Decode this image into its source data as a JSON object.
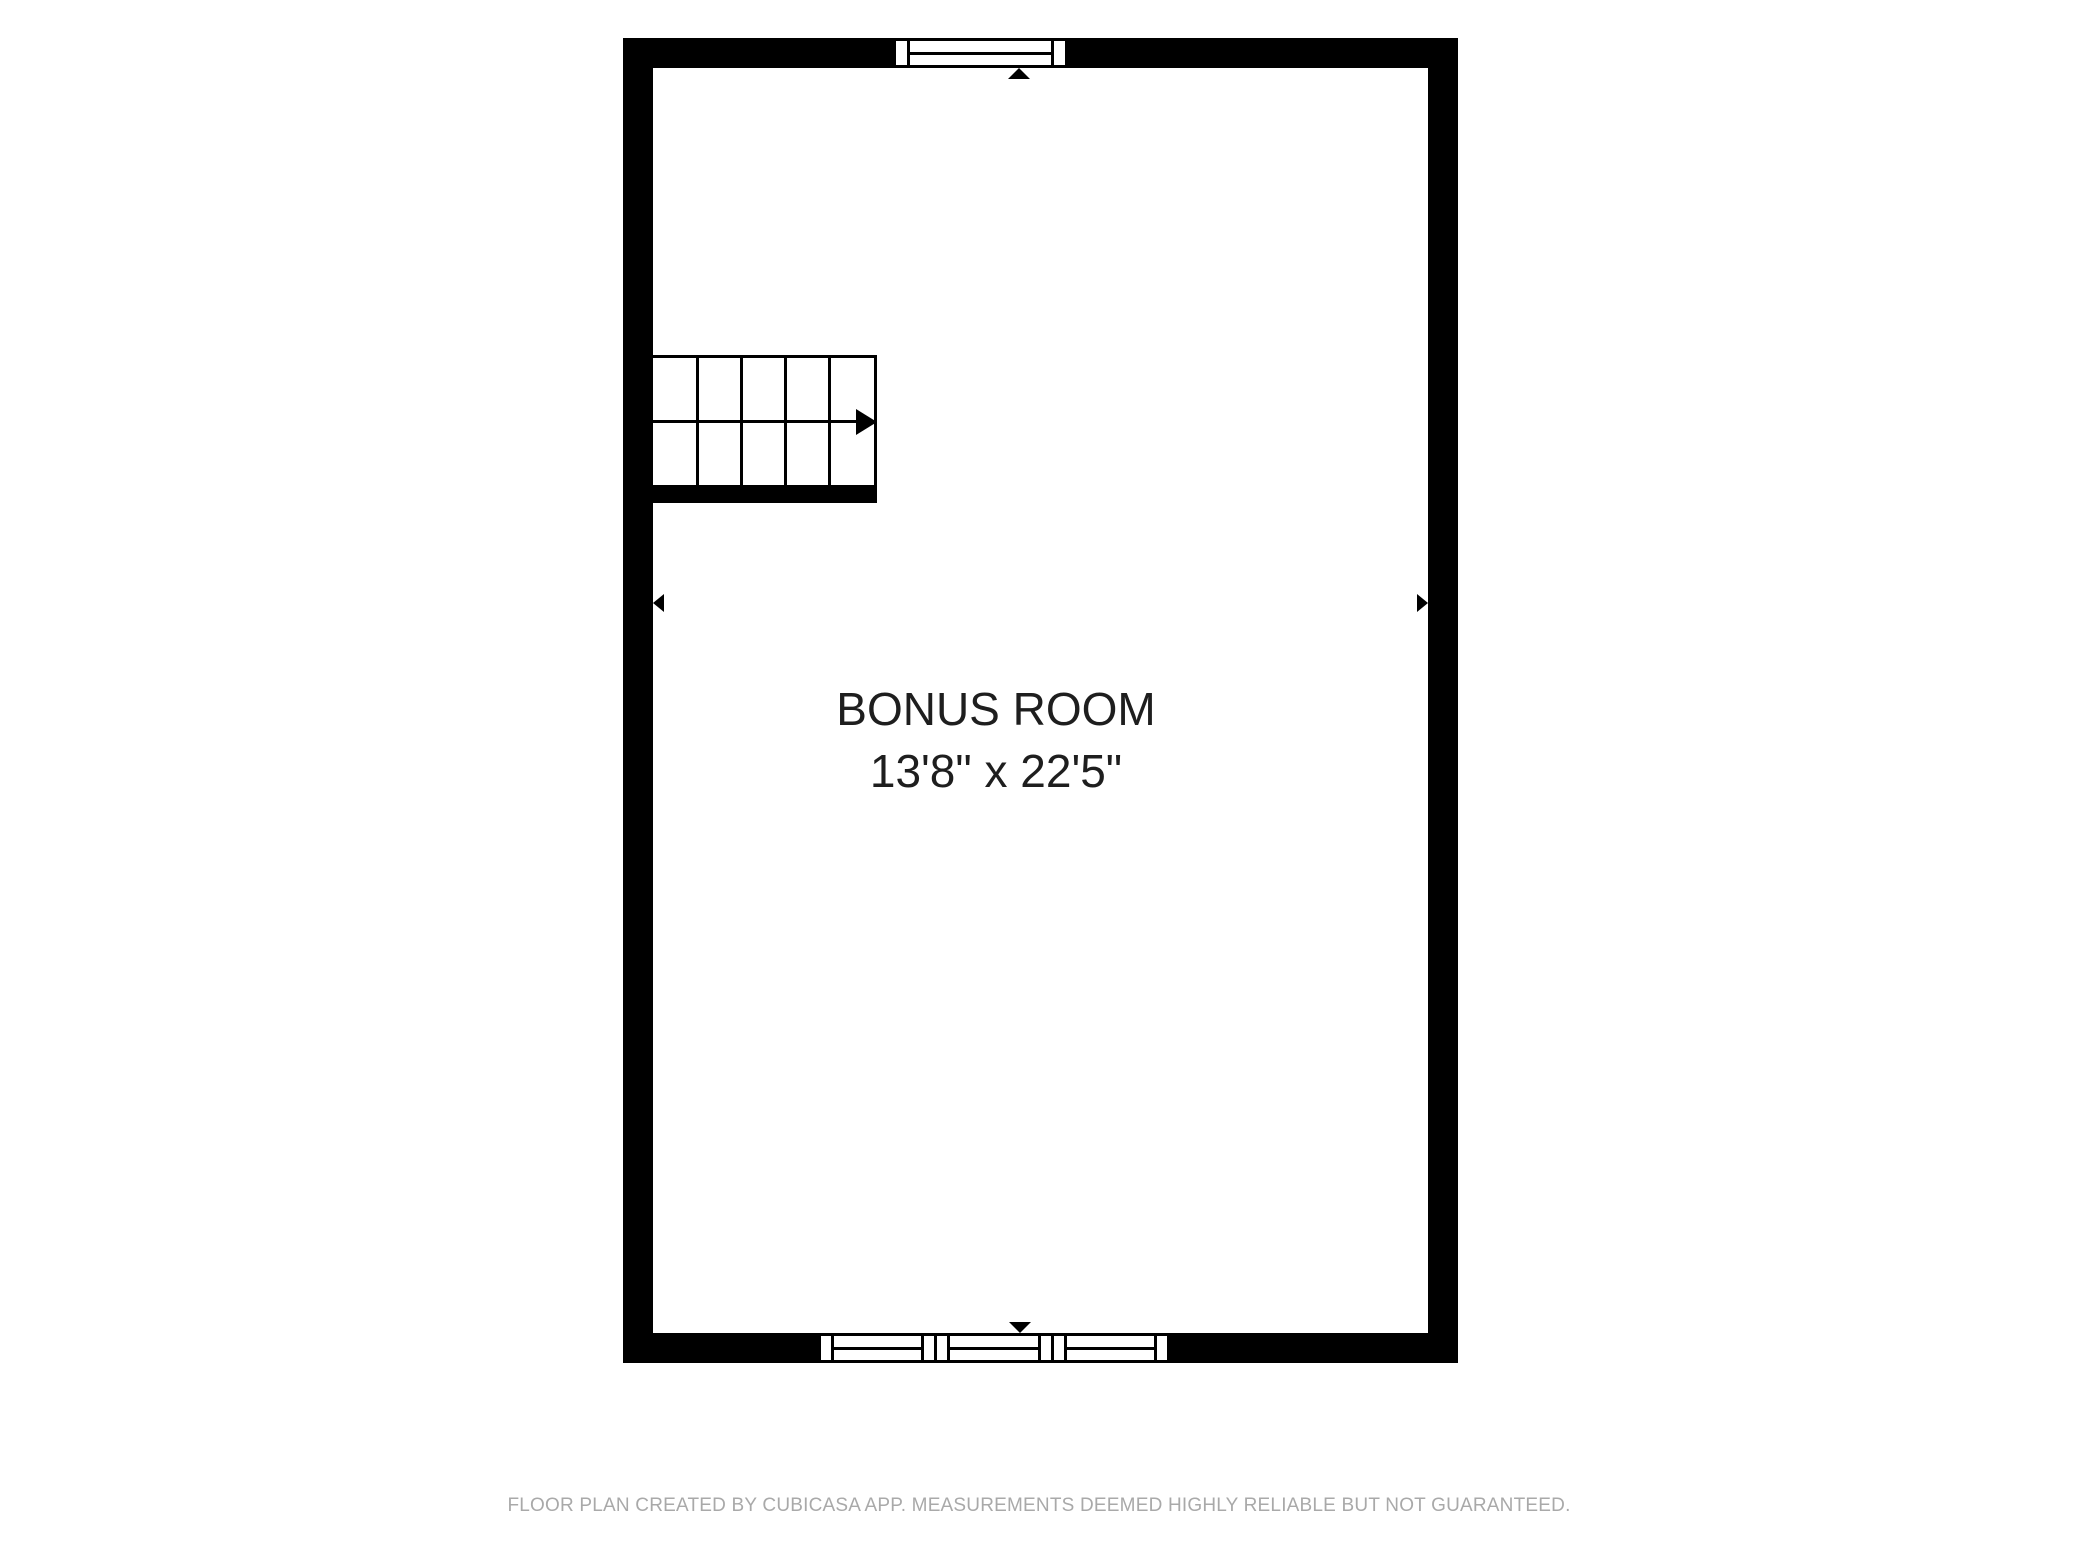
{
  "room": {
    "name": "BONUS ROOM",
    "dimensions": "13'8\" x 22'5\""
  },
  "stairs": {
    "columns": 5,
    "rows": 2,
    "direction": "right",
    "description": "straight staircase with run arrow pointing right"
  },
  "windows": {
    "top_wall_count": 1,
    "bottom_wall_count": 3
  },
  "markers": {
    "top": "up-triangle",
    "bottom": "down-triangle",
    "left": "left-triangle",
    "right": "right-triangle"
  },
  "footer": {
    "text": "FLOOR PLAN CREATED BY CUBICASA APP. MEASUREMENTS DEEMED HIGHLY RELIABLE BUT NOT GUARANTEED."
  },
  "colors": {
    "wall": "#000000",
    "background": "#ffffff",
    "room_text": "#1e1e1e",
    "footer_text": "#a9a9a9"
  }
}
